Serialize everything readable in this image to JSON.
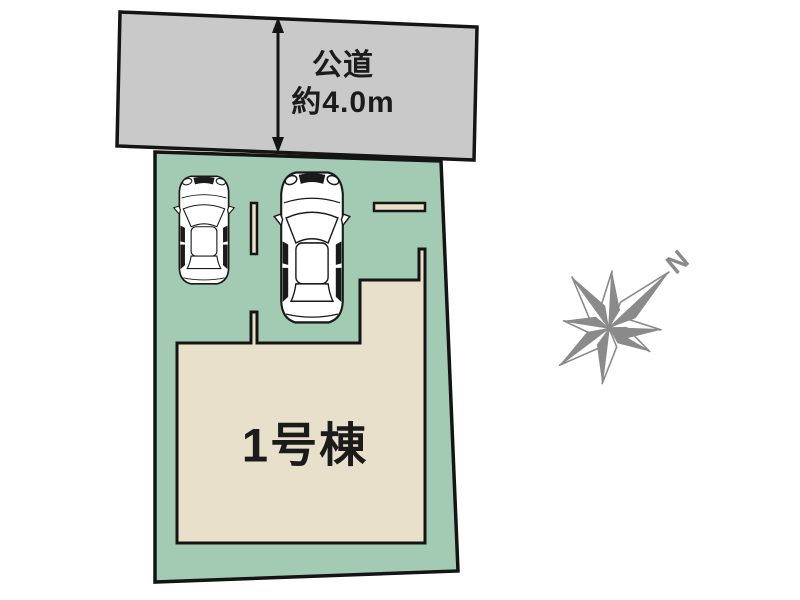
{
  "diagram": {
    "road": {
      "label_line1": "公道",
      "label_line2": "約4.0m",
      "fill": "#c9c9c9"
    },
    "plot": {
      "fill": "#a3cbb3"
    },
    "building": {
      "label": "1号棟",
      "fill": "#e8e0ca"
    },
    "parking": {
      "divider_fill": "#e8e0ca"
    },
    "compass": {
      "north_label": "N",
      "color": "#8a8a8a"
    },
    "cars": [
      {
        "icon": "compact-car-top-view-icon"
      },
      {
        "icon": "sedan-car-top-view-icon"
      }
    ],
    "line_color": "#141414"
  }
}
